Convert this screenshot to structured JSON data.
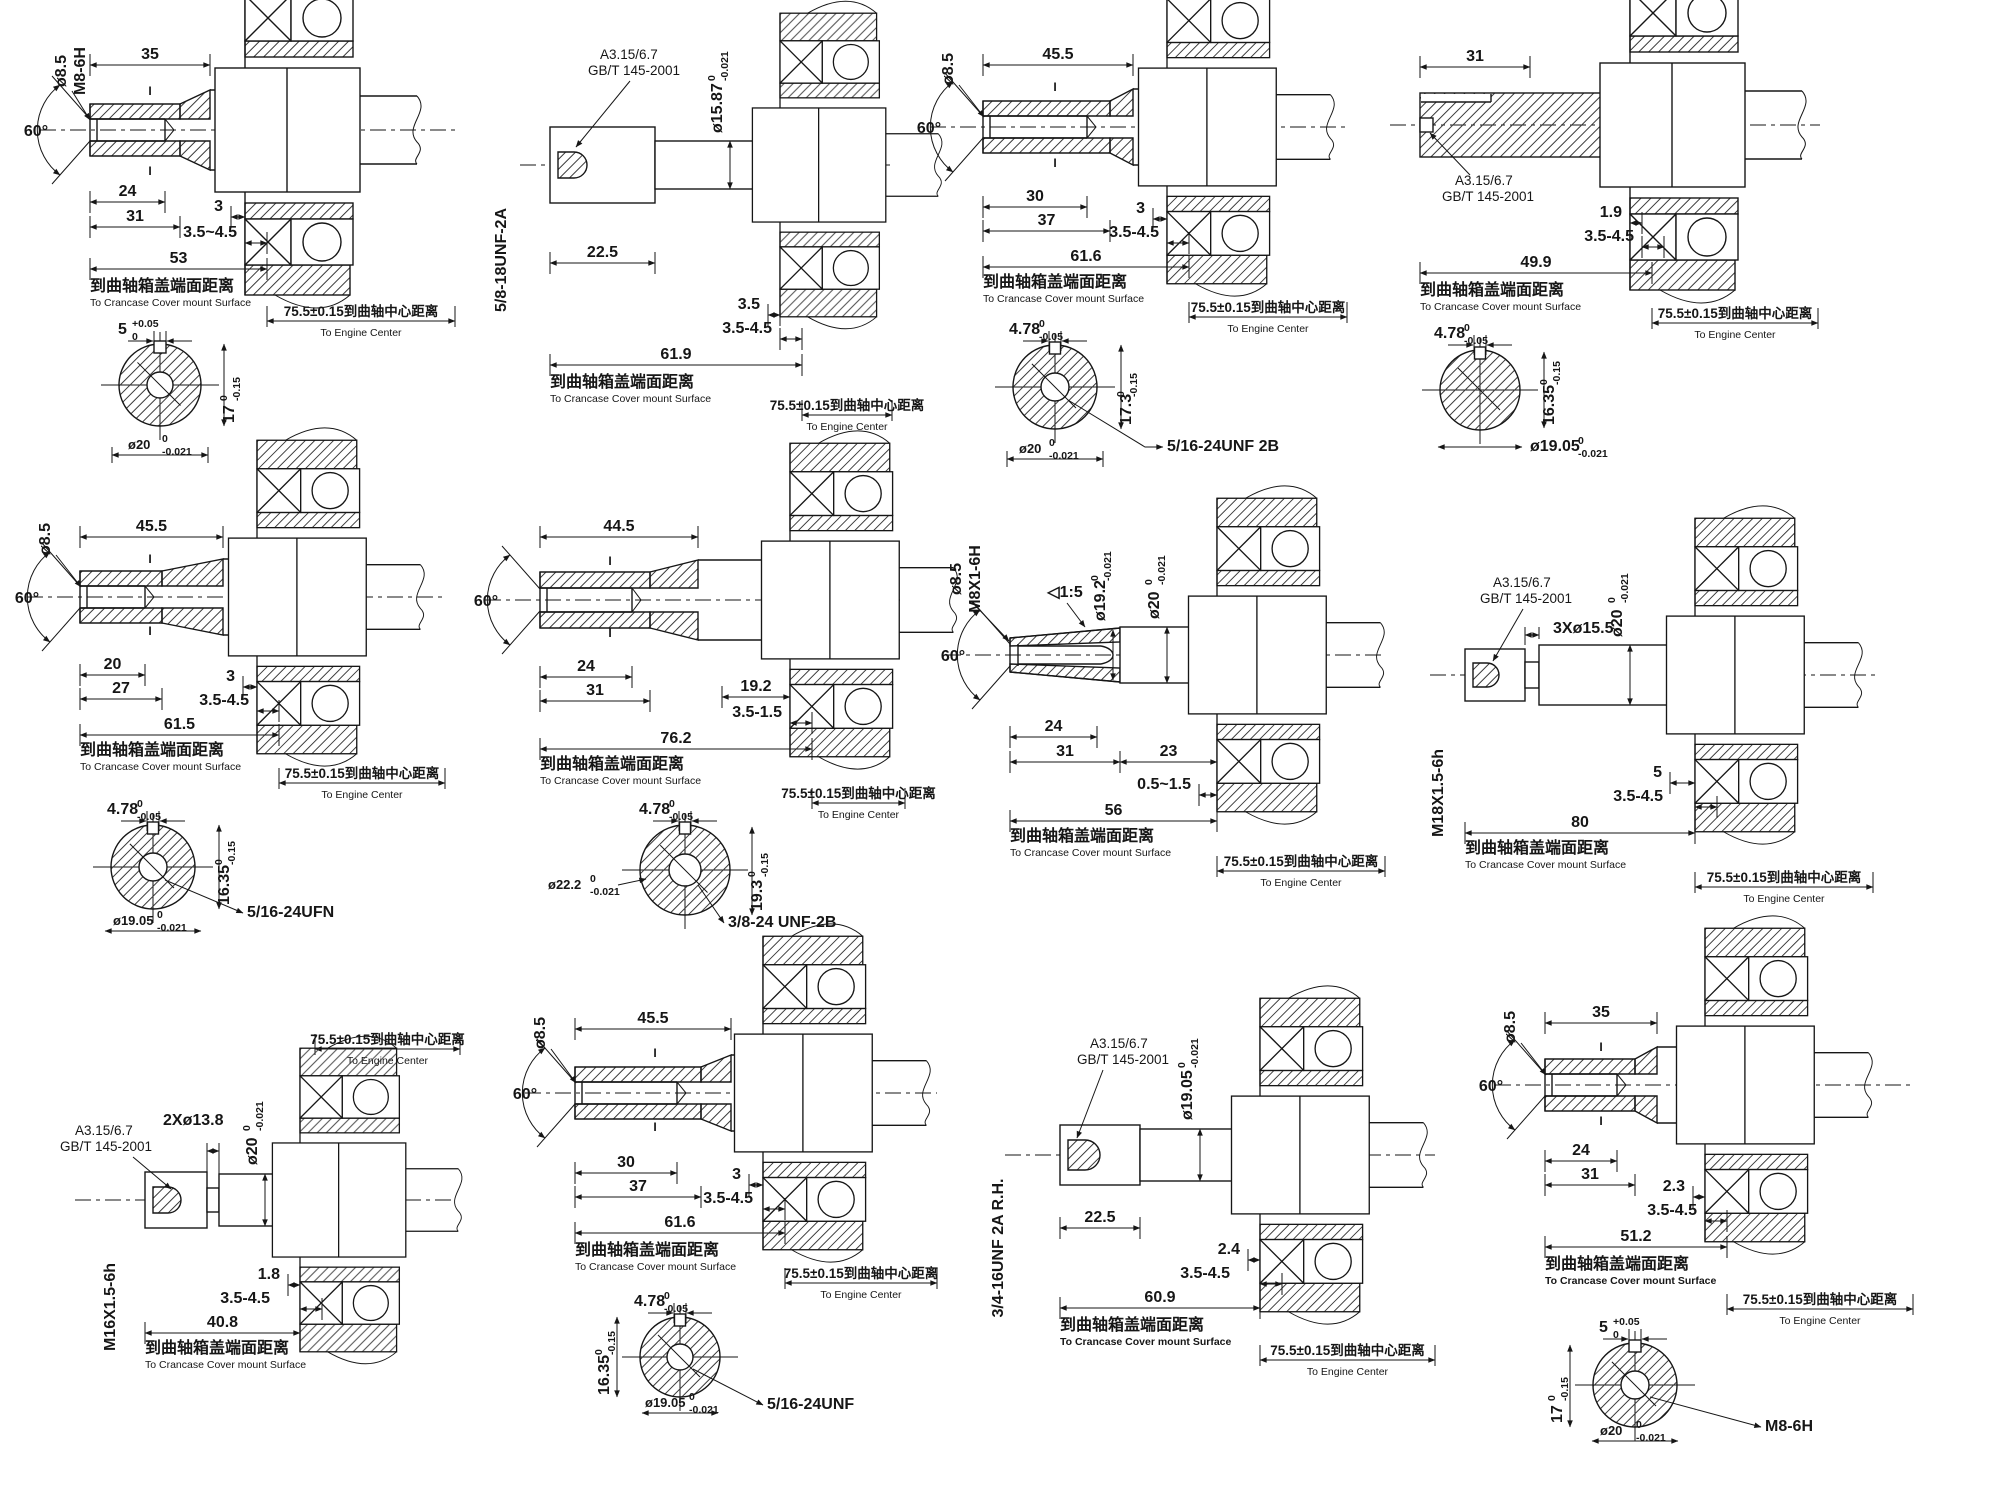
{
  "sheet": {
    "background": "#ffffff",
    "ink": "#161616",
    "title": "PTO shaft options drawing"
  },
  "shared": {
    "cover_cn": "到曲轴箱盖端面距离",
    "cover_en": "To Crancase Cover mount Surface",
    "center_cn": "75.5±0.15到曲轴中心距离",
    "center_en": "To Engine Center",
    "callout1": "A3.15/6.7",
    "callout2": "GB/T 145-2001",
    "section_mark": "I"
  },
  "panels": [
    {
      "angle": "60°",
      "dia": "ø8.5",
      "bore_thread": "M8-6H",
      "len_thread": "35",
      "len_bore": "24",
      "len_cbore": "31",
      "gap": "3",
      "range": "3.5~4.5",
      "total": "53",
      "section": {
        "key_w": {
          "v": "5",
          "u": "+0.05",
          "l": "0"
        },
        "height": {
          "v": "17",
          "u": "0",
          "l": "-0.15"
        },
        "dia": {
          "v": "ø20",
          "u": "0",
          "l": "-0.021"
        }
      }
    },
    {
      "thread": "5/8-18UNF-2A",
      "dia": {
        "v": "ø15.87",
        "u": "0",
        "l": "-0.021"
      },
      "len": "22.5",
      "gap": "3.5",
      "range": "3.5-4.5",
      "total": "61.9"
    },
    {
      "dia": "ø8.5",
      "angle": "60°",
      "len1": "45.5",
      "len2": "30",
      "len3": "37",
      "gap": "3",
      "range": "3.5-4.5",
      "total": "61.6",
      "section": {
        "key_w": {
          "v": "4.78",
          "u": "0",
          "l": "-0.05"
        },
        "height": {
          "v": "17.3",
          "u": "0",
          "l": "-0.15"
        },
        "dia": {
          "v": "ø20",
          "u": "0",
          "l": "-0.021"
        },
        "thread": "5/16-24UNF 2B"
      }
    },
    {
      "len1": "31",
      "gap": "1.9",
      "range": "3.5-4.5",
      "total": "49.9",
      "section": {
        "key_w": {
          "v": "4.78",
          "u": "0",
          "l": "-0.05"
        },
        "height": {
          "v": "16.35",
          "u": "0",
          "l": "-0.15"
        },
        "dia": {
          "v": "ø19.05",
          "u": "0",
          "l": "-0.021"
        }
      }
    },
    {
      "dia": "ø8.5",
      "angle": "60°",
      "len1": "45.5",
      "len2": "20",
      "len3": "27",
      "gap": "3",
      "range": "3.5-4.5",
      "total": "61.5",
      "section": {
        "key_w": {
          "v": "4.78",
          "u": "0",
          "l": "-0.05"
        },
        "height": {
          "v": "16.35",
          "u": "0",
          "l": "-0.15"
        },
        "thread": "5/16-24UFN",
        "dia": {
          "v": "ø19.05",
          "u": "0",
          "l": "-0.021"
        }
      }
    },
    {
      "angle": "60°",
      "len1": "44.5",
      "len2": "24",
      "len3": "31",
      "len4": "19.2",
      "range": "3.5-1.5",
      "total": "76.2",
      "section": {
        "key_w": {
          "v": "4.78",
          "u": "0",
          "l": "-0.05"
        },
        "dia": {
          "v": "ø22.2",
          "u": "0",
          "l": "-0.021"
        },
        "height": {
          "v": "19.3",
          "u": "0",
          "l": "-0.15"
        },
        "thread": "3/8-24 UNF-2B"
      }
    },
    {
      "dia": "ø8.5",
      "bore_thread": "M8X1-6H",
      "taper": "◁1:5",
      "angle": "60°",
      "len2": "24",
      "len3": "31",
      "len4": "23",
      "range": "0.5~1.5",
      "total": "56",
      "dia_taper": {
        "v": "ø19.2",
        "u": "0",
        "l": "-0.021"
      },
      "dia_shaft": {
        "v": "ø20",
        "u": "0",
        "l": "-0.021"
      }
    },
    {
      "neck": "3Xø15.5",
      "thread": "M18X1.5-6h",
      "gap": "5",
      "range": "3.5-4.5",
      "total": "80",
      "dia_shaft": {
        "v": "ø20",
        "u": "0",
        "l": "-0.021"
      }
    },
    {
      "neck": "2Xø13.8",
      "thread": "M16X1.5-6h",
      "gap": "1.8",
      "range": "3.5-4.5",
      "total": "40.8",
      "dia_shaft": {
        "v": "ø20",
        "u": "0",
        "l": "-0.021"
      }
    },
    {
      "dia": "ø8.5",
      "angle": "60°",
      "len1": "45.5",
      "len2": "30",
      "len3": "37",
      "gap": "3",
      "range": "3.5-4.5",
      "total": "61.6",
      "section": {
        "key_w": {
          "v": "4.78",
          "u": "0",
          "l": "-0.05"
        },
        "dia": {
          "v": "ø19.05",
          "u": "0",
          "l": "-0.021"
        },
        "height": {
          "v": "16.35",
          "u": "0",
          "l": "-0.15"
        },
        "thread": "5/16-24UNF"
      }
    },
    {
      "thread": "3/4-16UNF 2A R.H.",
      "len": "22.5",
      "gap": "2.4",
      "range": "3.5-4.5",
      "total": "60.9",
      "dia_shaft": {
        "v": "ø19.05",
        "u": "0",
        "l": "-0.021"
      }
    },
    {
      "dia": "ø8.5",
      "angle": "60°",
      "len1": "35",
      "len2": "24",
      "len3": "31",
      "gap": "2.3",
      "range": "3.5-4.5",
      "total": "51.2",
      "section": {
        "key_w": {
          "v": "5",
          "u": "+0.05",
          "l": "0"
        },
        "height": {
          "v": "17",
          "u": "0",
          "l": "-0.15"
        },
        "dia": {
          "v": "ø20",
          "u": "0",
          "l": "-0.021"
        },
        "thread": "M8-6H"
      }
    }
  ]
}
